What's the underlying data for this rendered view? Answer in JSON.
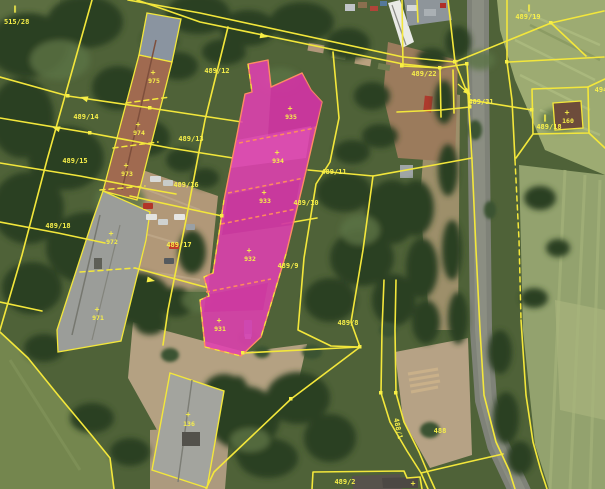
{
  "map": {
    "description": "Cadastral parcel map over aerial orthophoto with highlighted building parcel",
    "colors": {
      "boundary_line": "#f3e73b",
      "highlight_fill": "#e040b0",
      "highlight_outline": "#ff8c62",
      "label": "#f7ef4a"
    },
    "parcel_labels": [
      {
        "id": "parcel-515-28",
        "text": "515/28"
      },
      {
        "id": "parcel-489-12",
        "text": "489/12"
      },
      {
        "id": "parcel-489-13",
        "text": "489/13"
      },
      {
        "id": "parcel-489-14",
        "text": "489/14"
      },
      {
        "id": "parcel-489-15",
        "text": "489/15"
      },
      {
        "id": "parcel-489-16",
        "text": "489/16"
      },
      {
        "id": "parcel-489-17",
        "text": "489/17"
      },
      {
        "id": "parcel-489-18-left",
        "text": "489/18"
      },
      {
        "id": "parcel-489-11",
        "text": "489/11"
      },
      {
        "id": "parcel-489-10",
        "text": "489/10"
      },
      {
        "id": "parcel-489-9",
        "text": "489/9"
      },
      {
        "id": "parcel-489-8",
        "text": "489/8"
      },
      {
        "id": "parcel-489-19",
        "text": "489/19"
      },
      {
        "id": "parcel-489-22",
        "text": "489/22"
      },
      {
        "id": "parcel-489-31",
        "text": "489/31"
      },
      {
        "id": "parcel-489-18-right",
        "text": "489/18"
      },
      {
        "id": "parcel-494",
        "text": "494"
      },
      {
        "id": "parcel-488-1",
        "text": "488/1"
      },
      {
        "id": "parcel-488",
        "text": "488"
      },
      {
        "id": "parcel-489-2",
        "text": "489/2"
      }
    ],
    "building_labels": [
      {
        "id": "building-975",
        "text": "975"
      },
      {
        "id": "building-974",
        "text": "974"
      },
      {
        "id": "building-973",
        "text": "973"
      },
      {
        "id": "building-972",
        "text": "972"
      },
      {
        "id": "building-971",
        "text": "971"
      },
      {
        "id": "building-935",
        "text": "935"
      },
      {
        "id": "building-934",
        "text": "934"
      },
      {
        "id": "building-933",
        "text": "933"
      },
      {
        "id": "building-932",
        "text": "932"
      },
      {
        "id": "building-931",
        "text": "931"
      },
      {
        "id": "building-160",
        "text": "160"
      },
      {
        "id": "building-136",
        "text": "136"
      }
    ],
    "symbols": {
      "double_bar": "‖",
      "building_cross": "+"
    }
  }
}
